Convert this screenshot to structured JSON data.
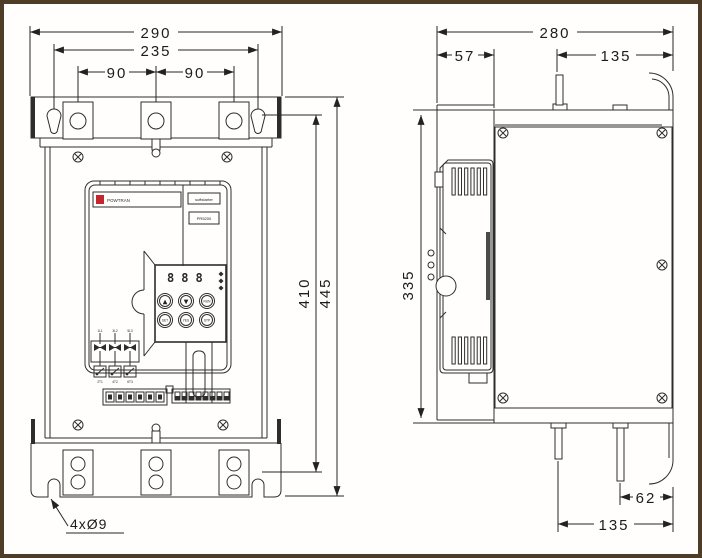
{
  "front_view": {
    "dims": {
      "overall_width": "290",
      "mount_width": "235",
      "pitch_left": "90",
      "pitch_right": "90",
      "mount_height": "410",
      "overall_height": "445"
    },
    "hole_note": "4xØ9",
    "panel": {
      "brand": "POWTRAN",
      "product": "softstarter",
      "model": "PR5200",
      "display": "888",
      "buttons": [
        "▲",
        "▼",
        "RUN",
        "SET",
        "YES",
        "STP"
      ],
      "scr_top": [
        "1L1",
        "3L2",
        "5L3"
      ],
      "scr_bottom": [
        "2T1",
        "4T2",
        "6T3"
      ]
    }
  },
  "side_view": {
    "dims": {
      "overall_depth": "280",
      "front_depth": "57",
      "top_stud_offset": "135",
      "body_height": "335",
      "stud2_offset": "62",
      "stud1_offset": "135"
    }
  },
  "colors": {
    "page_border": "#4f3c26",
    "line": "#2d2d2d",
    "logo_red": "#c1272d",
    "background": "#fffefc"
  }
}
